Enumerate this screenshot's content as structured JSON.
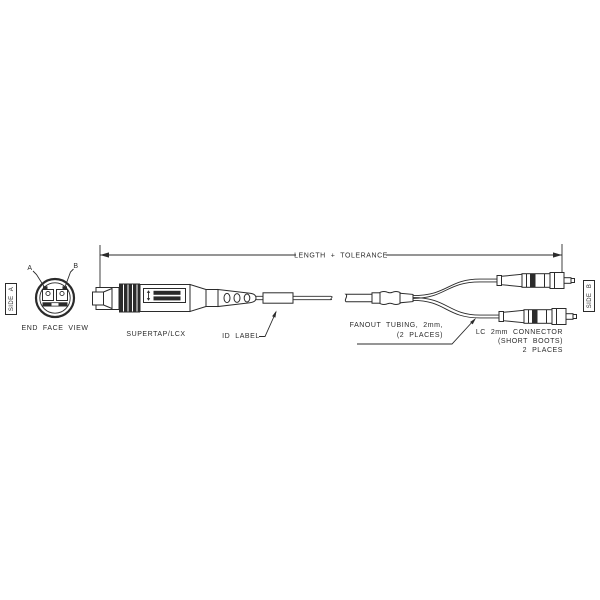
{
  "dimension": {
    "label": "LENGTH + TOLERANCE"
  },
  "end_face_view": {
    "caption": "END FACE VIEW",
    "label_a": "A",
    "label_b": "B"
  },
  "side_markers": {
    "left": "SIDE A",
    "right": "SIDE B"
  },
  "callouts": {
    "supertap": "SUPERTAP/LCX",
    "id_label": "ID LABEL",
    "fanout_line1": "FANOUT TUBING, 2mm,",
    "fanout_line2": "(2 PLACES)",
    "lc_line1": "LC 2mm CONNECTOR",
    "lc_line2": "(SHORT BOOTS)",
    "lc_line3": "2 PLACES"
  },
  "colors": {
    "line": "#2b2b2b",
    "background": "#ffffff"
  }
}
